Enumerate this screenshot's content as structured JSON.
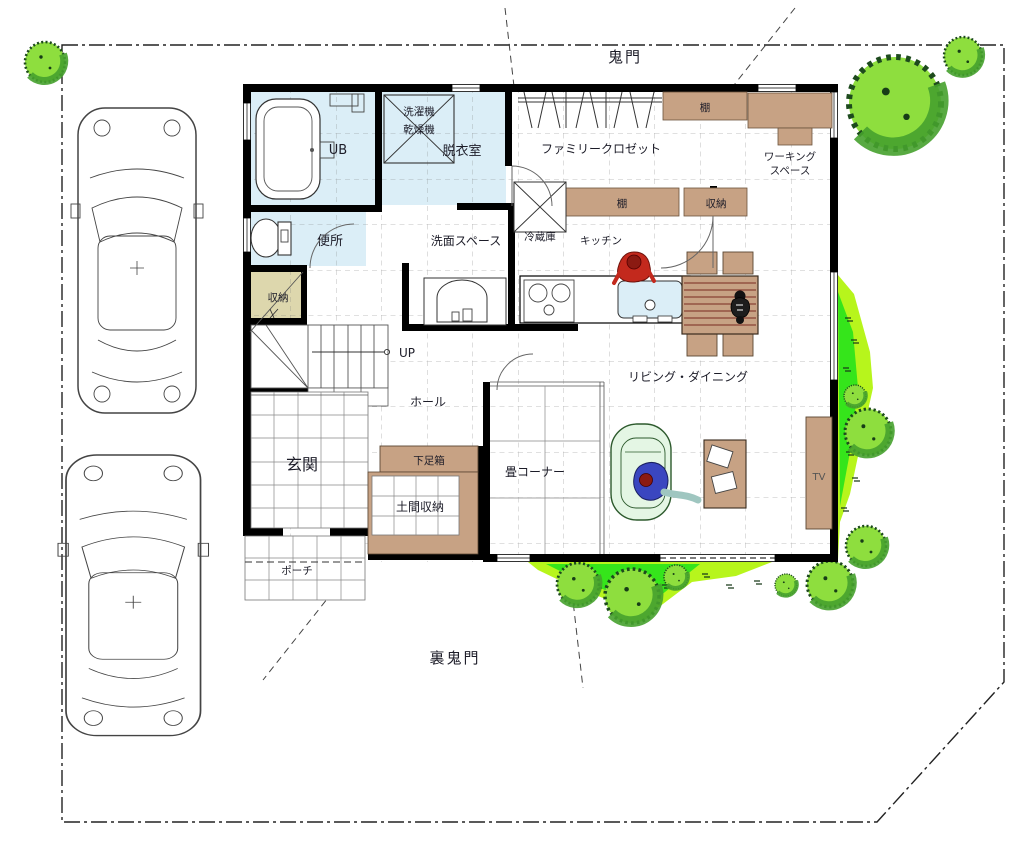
{
  "drawing": {
    "type": "floor-plan-site-plan",
    "orientation_labels": {
      "kimon": "鬼門",
      "ura_kimon": "裏鬼門"
    }
  },
  "labels": {
    "kimon": "鬼門",
    "ura_kimon": "裏鬼門",
    "ub": "UB",
    "washer": "洗濯機",
    "dryer": "乾燥機",
    "dressing_room": "脱衣室",
    "toilet": "便所",
    "washroom": "洗面スペース",
    "family_closet": "ファミリークロゼット",
    "shelf_top": "棚",
    "shelf_mid": "棚",
    "closet_storage": "収納",
    "working_line1": "ワーキング",
    "working_line2": "スペース",
    "fridge": "冷蔵庫",
    "kitchen": "キッチン",
    "living_dining": "リビング・ダイニング",
    "stair_storage": "収納",
    "up": "UP",
    "hall": "ホール",
    "entrance": "玄関",
    "shoe_box": "下足箱",
    "doma_storage": "土間収納",
    "tatami_corner": "畳コーナー",
    "porch": "ポーチ",
    "tv": "TV"
  },
  "colors": {
    "wall": "#000000",
    "room_blue": "#dbeef7",
    "furniture_tan": "#c7a284",
    "storage_olive": "#ddd7ad",
    "lawn_bright": "#b7f51c",
    "lawn_green": "#35e51b",
    "tree_light": "#8ede3e",
    "tree_dark": "#46a12e",
    "sofa_green": "#e4f6e4",
    "person_red": "#c3291d",
    "person_blue": "#3a46c0",
    "table_grain_red": "#7a2a1f"
  }
}
